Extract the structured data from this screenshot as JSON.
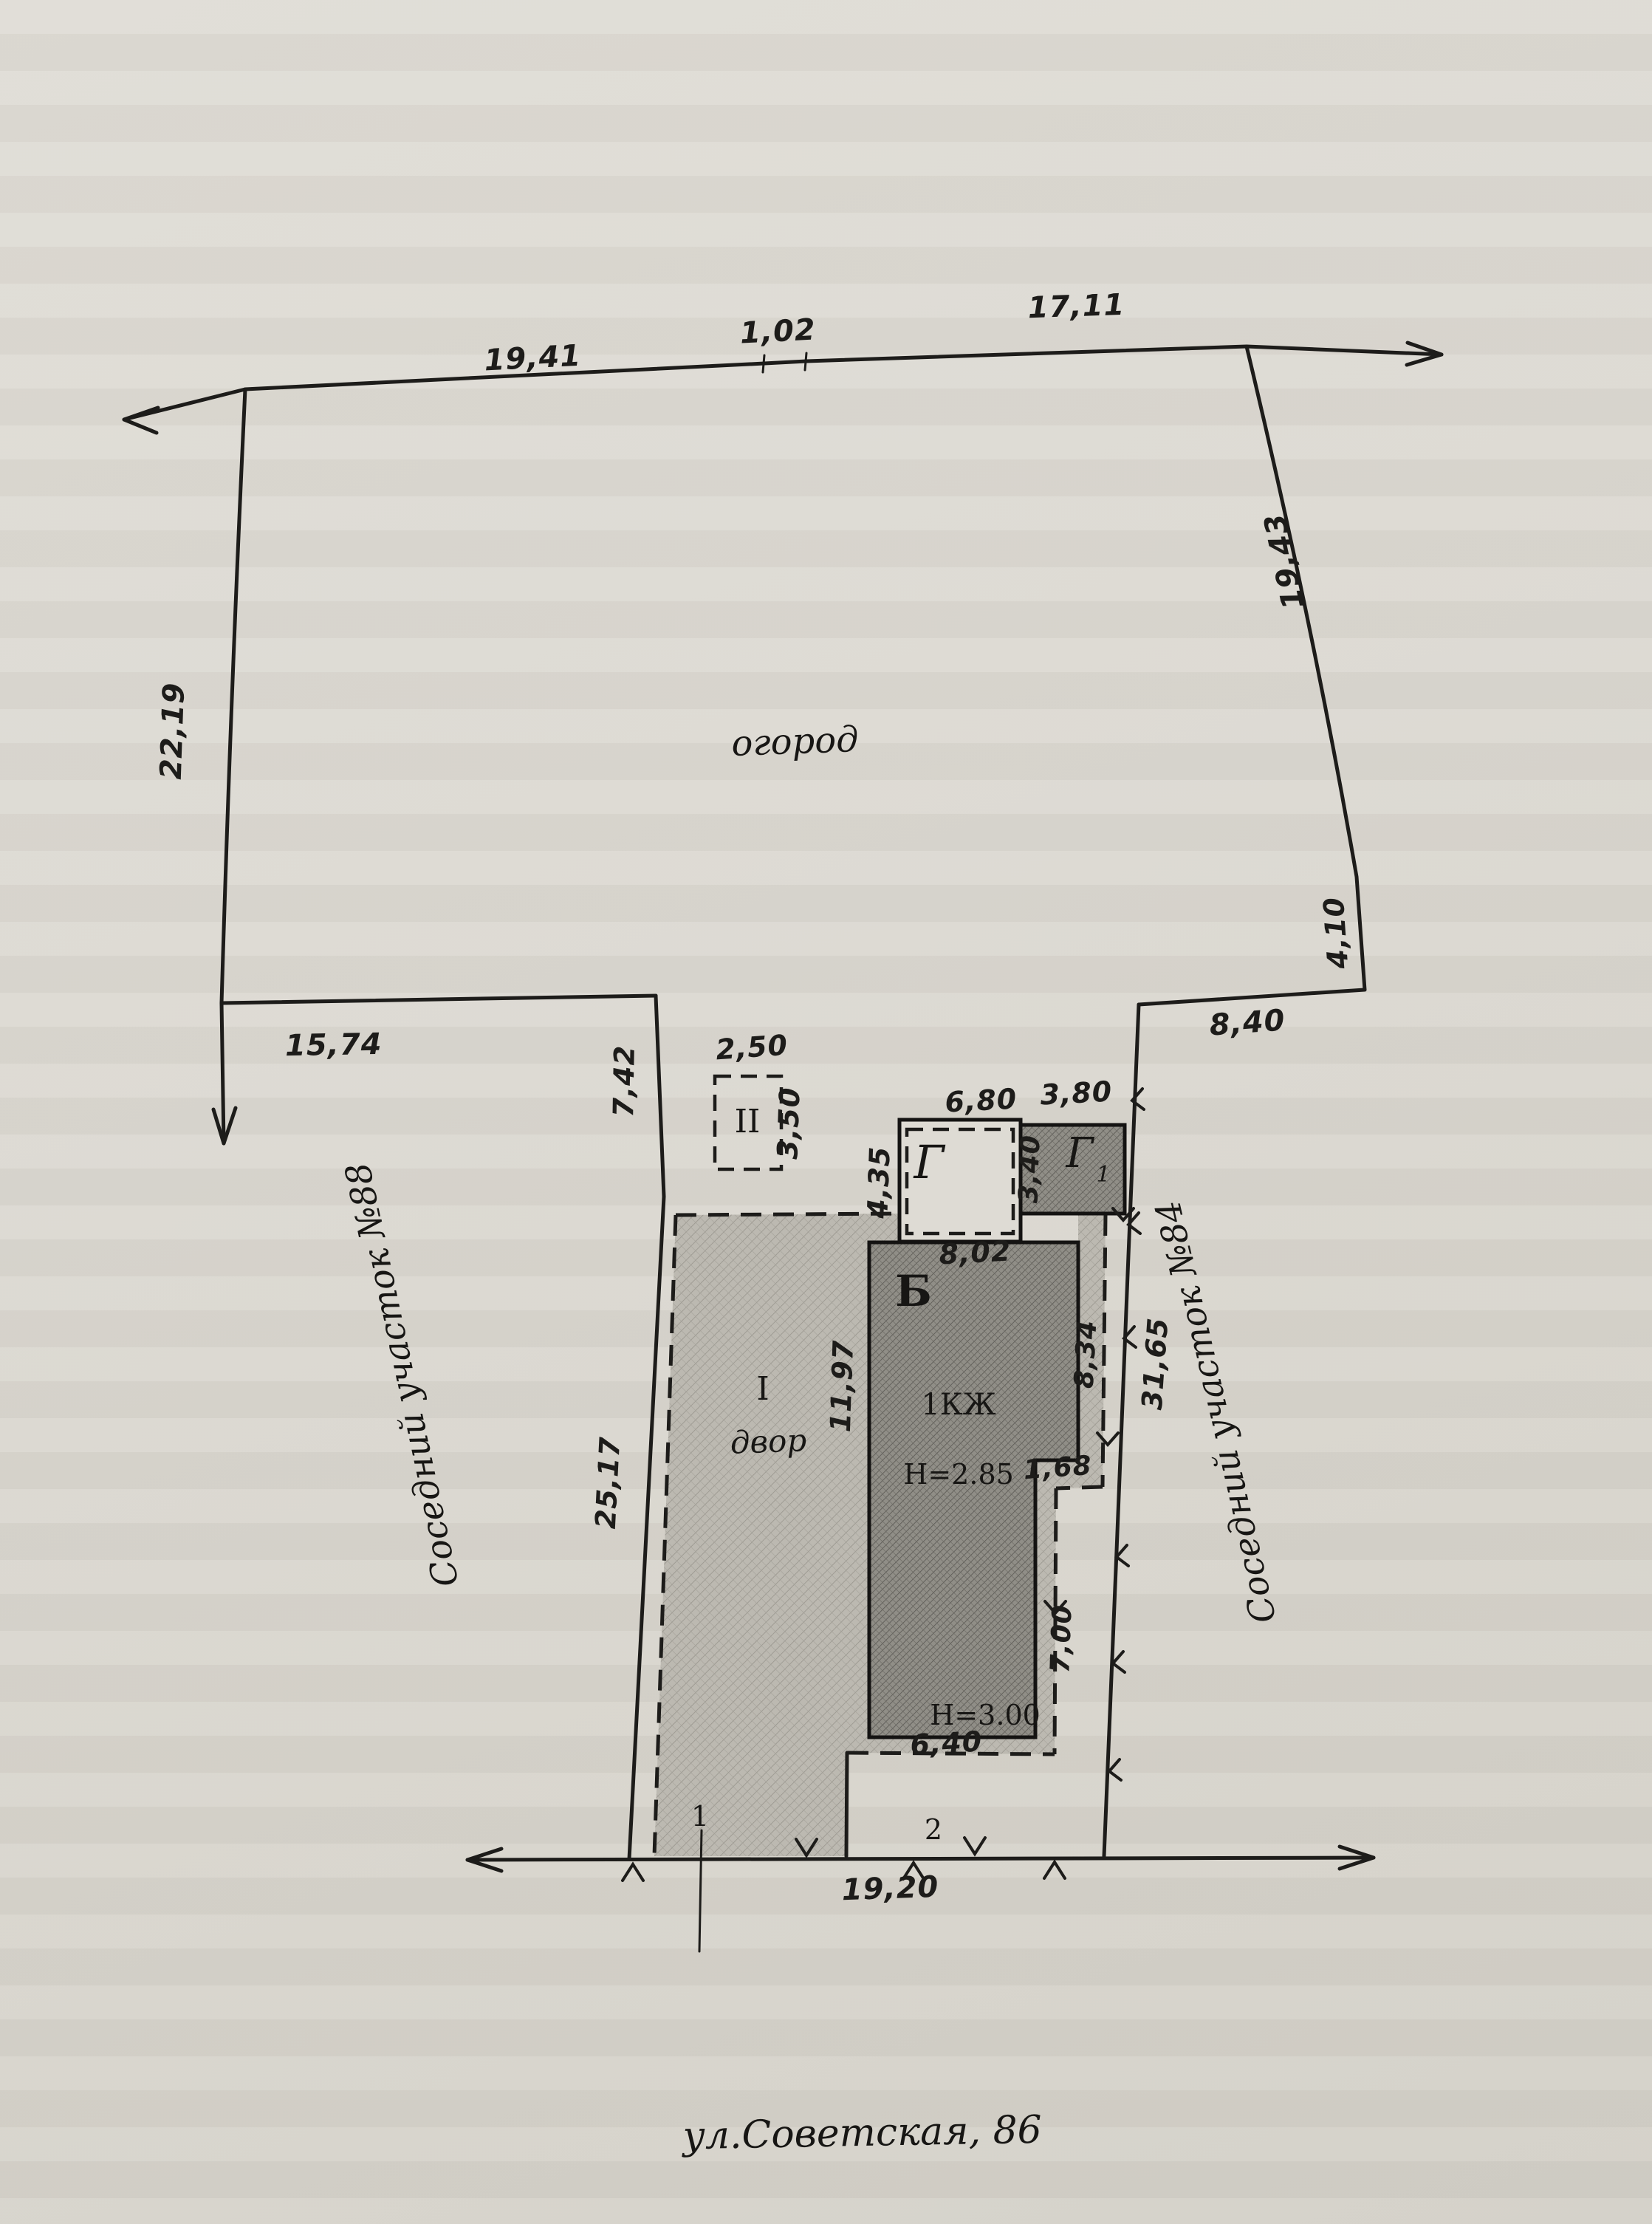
{
  "street": {
    "label": "ул.Советская, 86"
  },
  "neighbors": {
    "left": "Соседний участок №88",
    "right": "Соседний участок №84"
  },
  "areas": {
    "garden": "огород",
    "yard": "двор",
    "yard_roman": "I",
    "structure_roman": "II"
  },
  "buildings": {
    "main": {
      "letter": "Б",
      "type": "1КЖ",
      "height_upper": "Н=2.85",
      "height_lower": "Н=3.00"
    },
    "shed": {
      "letter": "Г"
    },
    "shed1": {
      "letter": "Г",
      "index": "1"
    }
  },
  "points": {
    "p1": "1",
    "p2": "2"
  },
  "dimensions": {
    "top_1": "19,41",
    "top_2": "1,02",
    "top_3": "17,11",
    "left_upper": "22,19",
    "left_mid": "15,74",
    "left_inner": "7,42",
    "left_lower": "25,17",
    "right_upper": "19,43",
    "right_jog": "4,10",
    "right_top": "8,40",
    "right_lower": "31,65",
    "shed2_w": "2,50",
    "shed2_h": "3,50",
    "g_w": "6,80",
    "g_h": "4,35",
    "g1_w": "3,80",
    "g1_h": "3,40",
    "b_w": "8,02",
    "b_h": "11,97",
    "b_right": "8,34",
    "b_step": "1,68",
    "b_strip": "7,00",
    "b_bottom": "6,40",
    "street_front": "19,20"
  }
}
